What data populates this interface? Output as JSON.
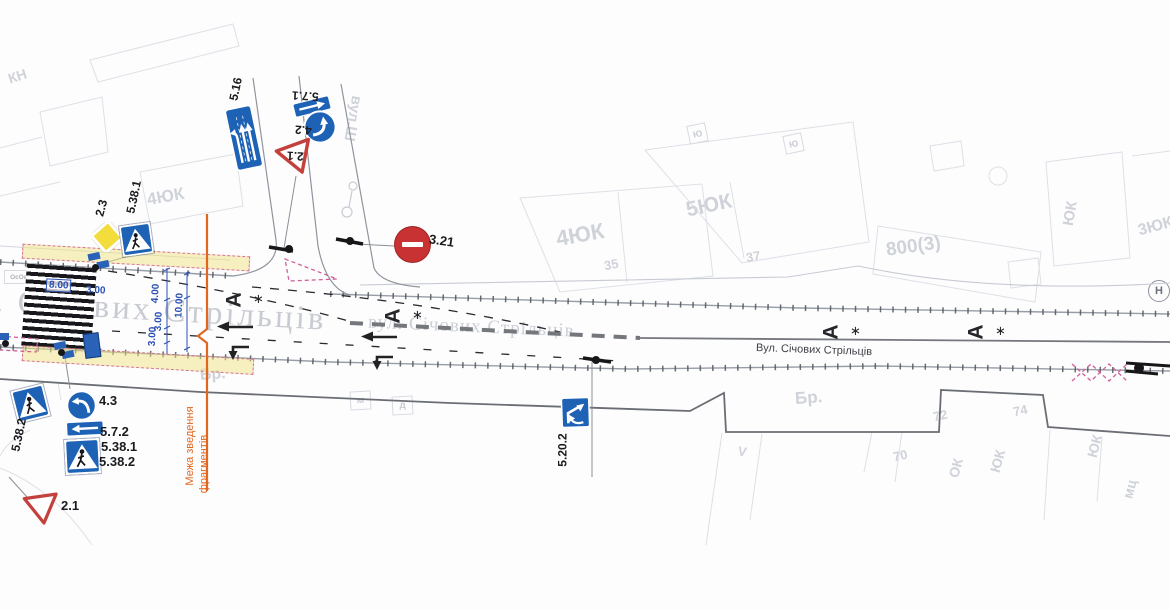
{
  "signs": {
    "s5_16": "5.16",
    "s5_7_1": "5.7.1",
    "s4_2": "4.2",
    "s2_1_top": "2.1",
    "s2_3": "2.3",
    "s5_38_1_left": "5.38.1",
    "s3_21": "3.21",
    "s5_38_2_side": "5.38.2",
    "s4_3": "4.3",
    "s5_7_2": "5.7.2",
    "s5_38_1_bot": "5.38.1",
    "s5_38_2_bot": "5.38.2",
    "s2_1_bot": "2.1",
    "s5_20_2": "5.20.2"
  },
  "dimensions": {
    "w8": "8.00",
    "w3": "3.00",
    "v4": "4.00",
    "v10": "10.00",
    "v3a": "3.00",
    "v3b": "3.00"
  },
  "streets": {
    "main_large": "вул. Січових Стрільців",
    "main_mid": "вул. Січових Стрільців",
    "main_small": "Вул. Січових Стрільців",
    "side_top": "вул.Ш"
  },
  "boundary": {
    "line1": "Межа зведення",
    "line2": "фрагментів"
  },
  "road_markings": {
    "bus_letter": "А",
    "star": "∗"
  },
  "buildings": {
    "kn": "КН",
    "b4yuk_left": "4ЮК",
    "b4yuk_mid": "4ЮК",
    "n35": "35",
    "b5yuk": "5ЮК",
    "n37": "37",
    "b800": "800(3)",
    "yuk_right_top": "ЮК",
    "b3yuk": "3ЮК",
    "br_left": "Бр.",
    "br_right": "Бр.",
    "n70": "70",
    "n72": "72",
    "n74": "74",
    "ok_bot": "ОК",
    "yuk_bot_a": "ЮК",
    "yuk_bot_b": "ЮК",
    "mts": "мц",
    "yu_a": "Ю",
    "yu_b": "Ю",
    "m_box": "м",
    "d_box": "д",
    "n_circle": "Н",
    "v_mark": "V",
    "osov": "ОсОв"
  }
}
